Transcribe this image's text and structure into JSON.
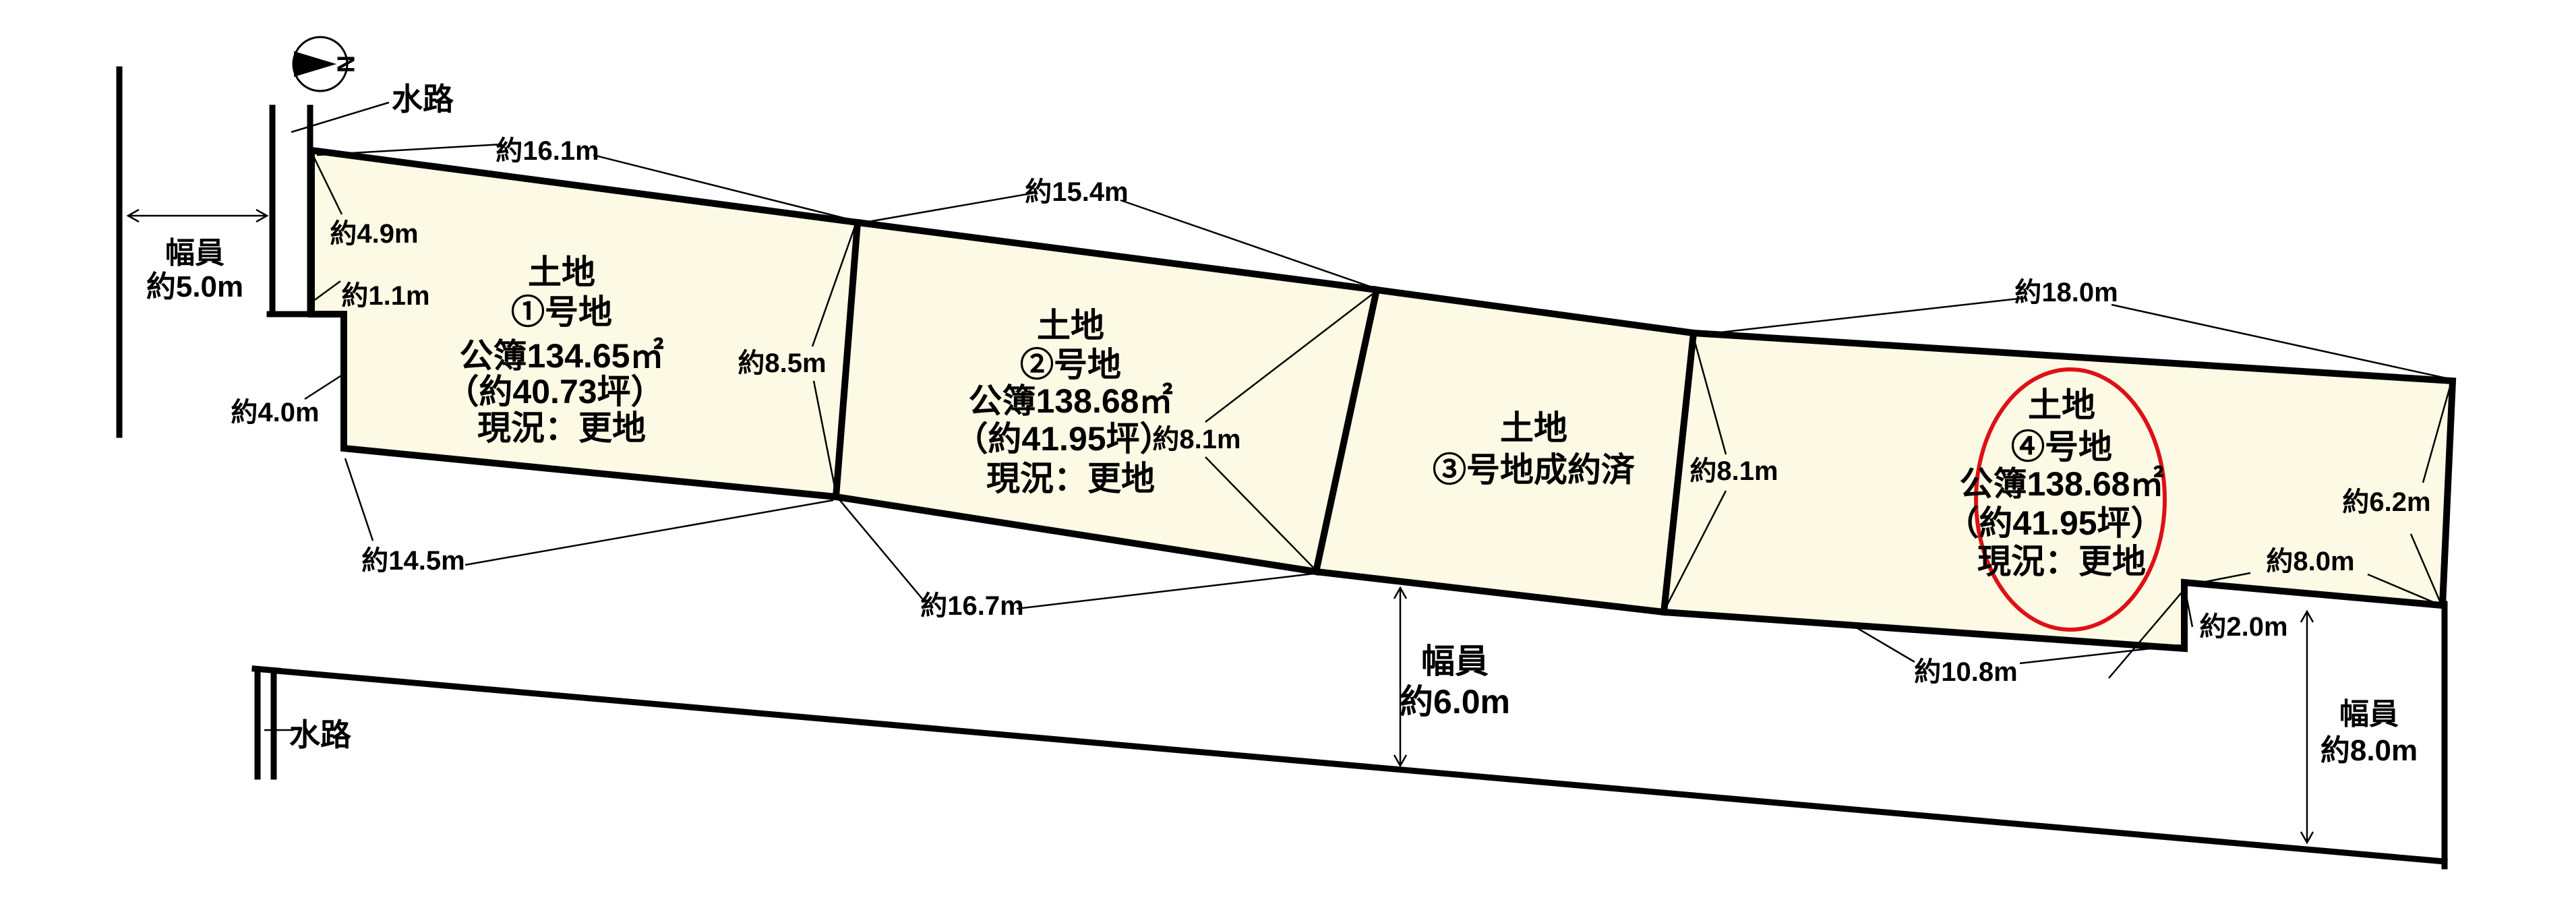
{
  "colors": {
    "background": "#ffffff",
    "plot_fill": "#fcfae5",
    "line": "#000000",
    "highlight": "#dd1115"
  },
  "compass": {
    "north_label": "N"
  },
  "waterways": {
    "top_label": "水路",
    "bottom_label": "水路"
  },
  "roads": {
    "left": {
      "label_line1": "幅員",
      "label_line2": "約5.0m"
    },
    "bottom": {
      "label_line1": "幅員",
      "label_line2": "約6.0m"
    },
    "right": {
      "label_line1": "幅員",
      "label_line2": "約8.0m"
    }
  },
  "plots": [
    {
      "name_line1": "土地",
      "name_line2": "①号地",
      "area_sqm": "公簿134.65㎡",
      "area_tsubo": "（約40.73坪）",
      "status": "現況：更地",
      "dimensions": {
        "top": "約16.1m",
        "left_upper": "約4.9m",
        "left_middle": "約1.1m",
        "left_lower": "約4.0m",
        "right": "約8.5m",
        "bottom": "約14.5m"
      }
    },
    {
      "name_line1": "土地",
      "name_line2": "②号地",
      "area_sqm": "公簿138.68㎡",
      "area_tsubo": "（約41.95坪）",
      "status": "現況：更地",
      "dimensions": {
        "top": "約15.4m",
        "right": "約8.1m",
        "bottom": "約16.7m"
      }
    },
    {
      "name_line1": "土地",
      "name_line2": "③号地成約済",
      "dimensions": {
        "right": "約8.1m"
      }
    },
    {
      "name_line1": "土地",
      "name_line2": "④号地",
      "area_sqm": "公簿138.68㎡",
      "area_tsubo": "（約41.95坪）",
      "status": "現況：更地",
      "dimensions": {
        "top": "約18.0m",
        "right": "約6.2m",
        "bottom_right": "約8.0m",
        "step": "約2.0m",
        "bottom_left": "約10.8m"
      }
    }
  ]
}
